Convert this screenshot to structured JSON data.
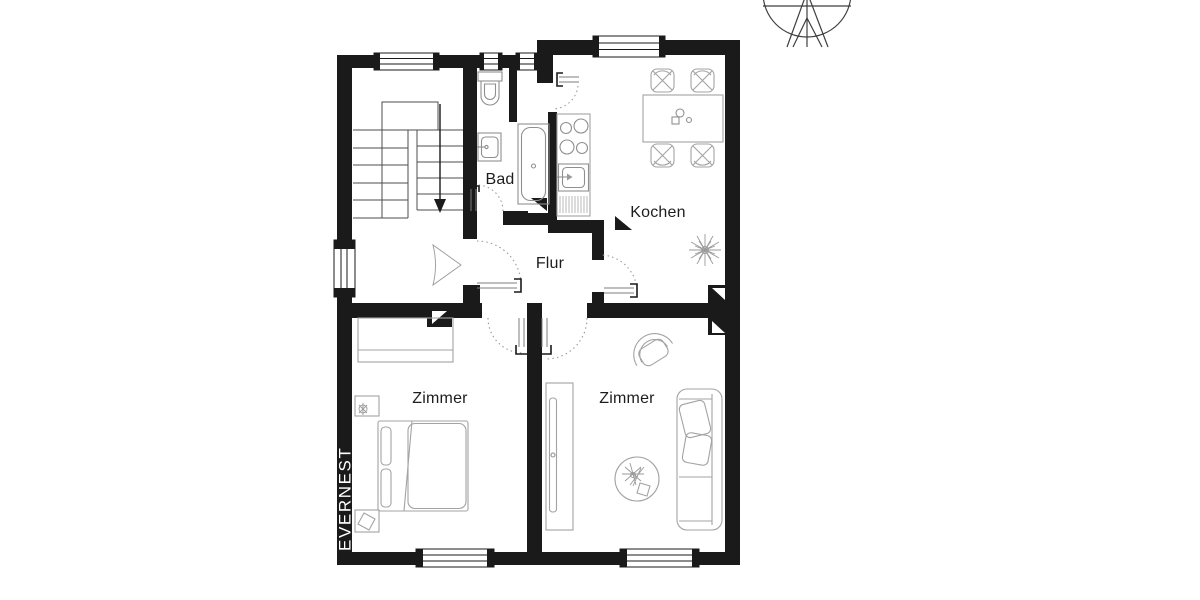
{
  "brand": {
    "label": "EVERNEST"
  },
  "floor_plan": {
    "rooms": [
      {
        "id": "bad",
        "label": "Bad"
      },
      {
        "id": "kochen",
        "label": "Kochen"
      },
      {
        "id": "flur",
        "label": "Flur"
      },
      {
        "id": "zimmer_left",
        "label": "Zimmer"
      },
      {
        "id": "zimmer_right",
        "label": "Zimmer"
      }
    ],
    "stairs": {
      "direction": "down"
    },
    "compass": {
      "type": "north-arrow"
    },
    "fixtures": [
      "stairs",
      "entrance-door",
      "toilet",
      "wash-basin",
      "bathtub",
      "kitchen-counter",
      "stove",
      "kitchen-sink",
      "dish-rack",
      "dining-table",
      "chairs",
      "plant",
      "wardrobe",
      "double-bed",
      "nightstands",
      "sideboard",
      "round-rug",
      "sofa",
      "armchair"
    ],
    "colors": {
      "wall": "#1a1a1a",
      "furniture_line": "#a3a3a3",
      "label": "#1d1d1b",
      "background": "#ffffff",
      "brand_text": "#ffffff"
    }
  }
}
